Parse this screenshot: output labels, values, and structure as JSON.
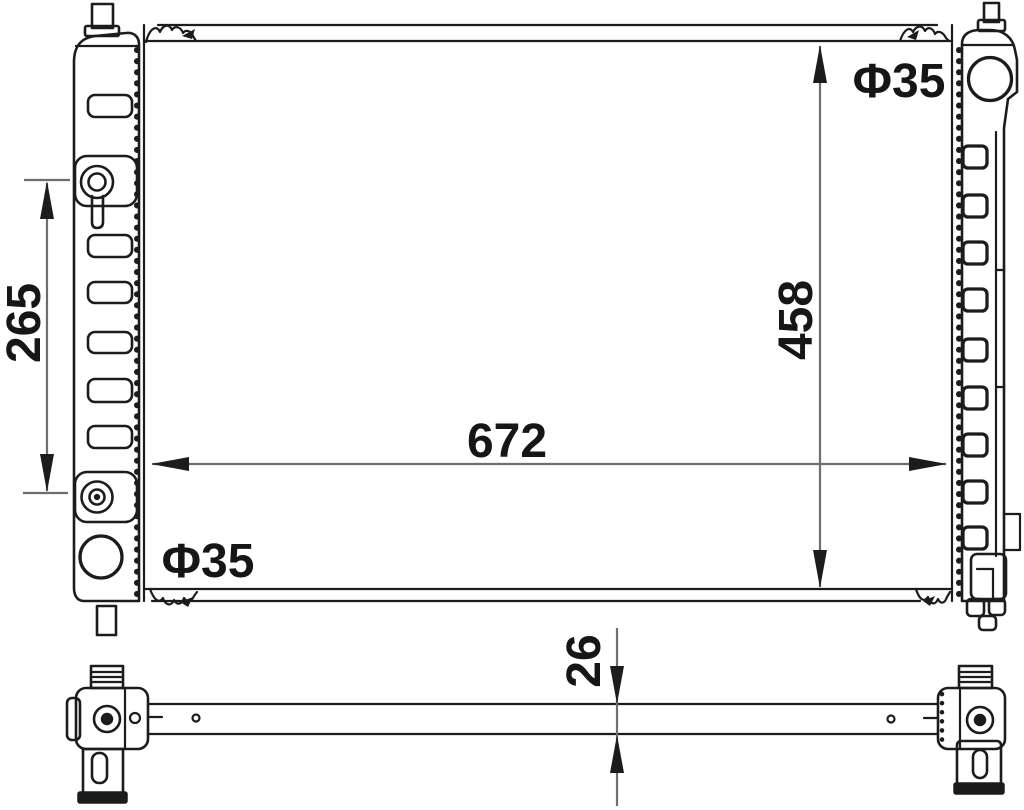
{
  "colors": {
    "line": "#1c1c1c",
    "dimension": "#6e6e6e",
    "text": "#161616",
    "background": "#ffffff"
  },
  "dimensions": {
    "port_spacing": {
      "value": "265"
    },
    "core_height": {
      "value": "458"
    },
    "core_width": {
      "value": "672"
    },
    "core_thickness": {
      "value": "26"
    },
    "inlet_diameter": {
      "value": "Φ35"
    },
    "outlet_diameter": {
      "value": "Φ35"
    }
  }
}
